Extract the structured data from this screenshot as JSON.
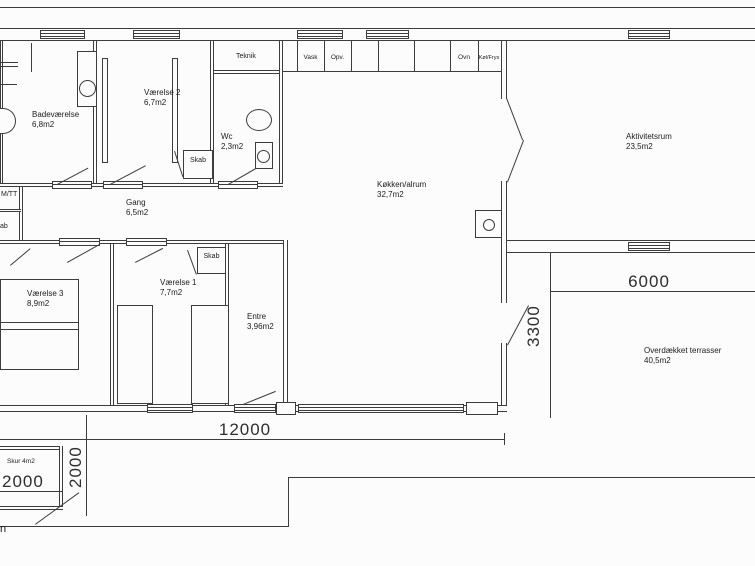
{
  "rooms": {
    "badevaerelse": {
      "name": "Badeværelse",
      "area": "6,8m2"
    },
    "vaerelse2": {
      "name": "Værelse 2",
      "area": "6,7m2"
    },
    "teknik": {
      "name": "Teknik"
    },
    "wc": {
      "name": "Wc",
      "area": "2,3m2"
    },
    "gang": {
      "name": "Gang",
      "area": "6,5m2"
    },
    "koekken": {
      "name": "Køkken/alrum",
      "area": "32,7m2"
    },
    "aktivitetsrum": {
      "name": "Aktivitetsrum",
      "area": "23,5m2"
    },
    "vaerelse3": {
      "name": "Værelse 3",
      "area": "8,9m2"
    },
    "vaerelse1": {
      "name": "Værelse 1",
      "area": "7,7m2"
    },
    "entre": {
      "name": "Entre",
      "area": "3,96m2"
    },
    "terrasse": {
      "name": "Overdækket terrasser",
      "area": "40,5m2"
    },
    "skur": {
      "name": "Skur 4m2"
    }
  },
  "closets": {
    "upper": "Skab",
    "lower": "Skab"
  },
  "appliances": {
    "vask": "Vask",
    "opv": "Opv.",
    "ovn": "Ovn",
    "koel_frys": "Køl/Frys"
  },
  "partial_text": {
    "mtt": "M/TT",
    "skab_cut": "ab",
    "bottom_left": "n"
  },
  "dimensions": {
    "house_width": "12000",
    "terrace_width": "6000",
    "terrace_depth": "3300",
    "skur_width": "2000",
    "skur_depth": "2000"
  },
  "colors": {
    "ink": "#3c3c3c",
    "paper": "#fcfcfc"
  }
}
